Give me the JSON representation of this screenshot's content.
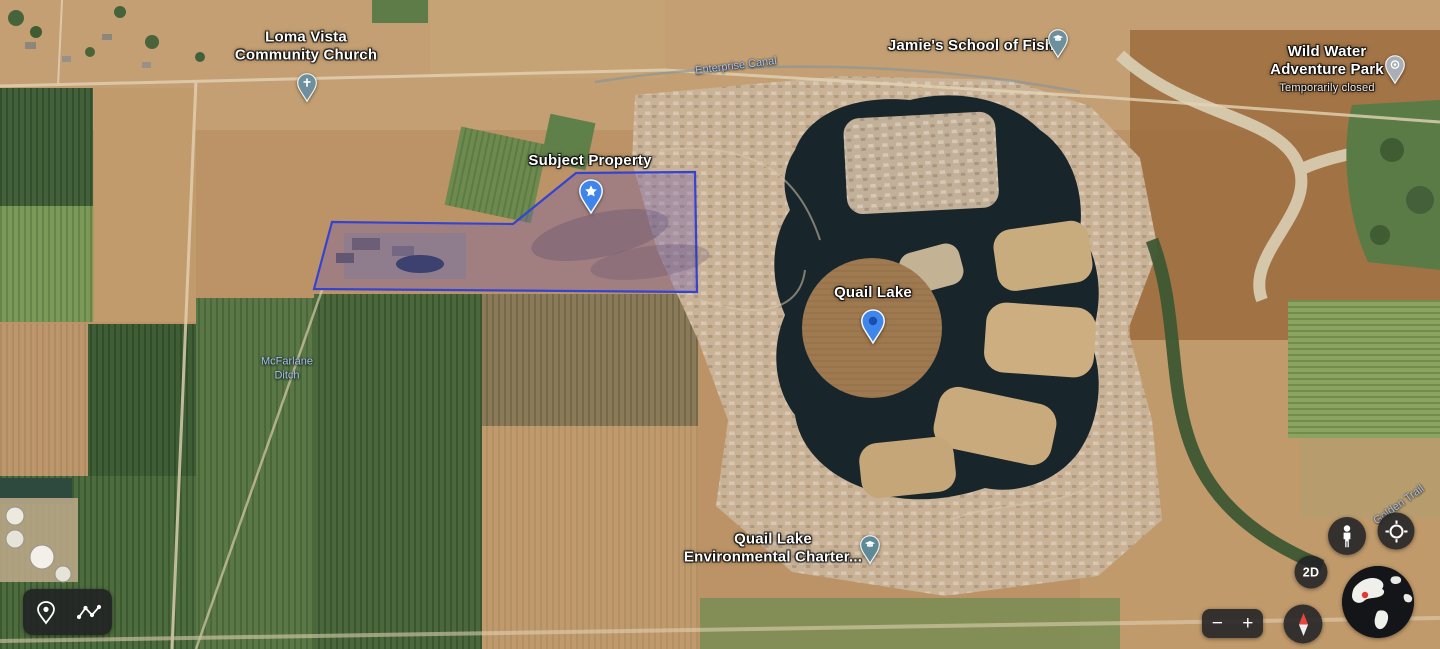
{
  "labels": {
    "loma_vista": {
      "line1": "Loma Vista",
      "line2": "Community Church"
    },
    "enterprise_canal": {
      "text": "Enterprise Canal"
    },
    "jamies_school": {
      "text": "Jamie's School of Fish"
    },
    "wild_water": {
      "line1": "Wild Water",
      "line2": "Adventure Park",
      "status": "Temporarily closed"
    },
    "subject_property": {
      "text": "Subject Property"
    },
    "quail_lake": {
      "text": "Quail Lake"
    },
    "mcfarlane_ditch": {
      "line1": "McFarlane",
      "line2": "Ditch"
    },
    "environmental_charter": {
      "line1": "Quail Lake",
      "line2": "Environmental Charter..."
    },
    "road": {
      "text": "Golden Trail"
    }
  },
  "controls": {
    "zoom_out_label": "−",
    "zoom_in_label": "+",
    "mode_2d_label": "2D"
  },
  "colors": {
    "subject_polygon_stroke": "#3543d2",
    "subject_polygon_fill": "rgba(112,88,182,0.34)",
    "primary_pin_blue": "#3e86ec",
    "pin_inner_dark_blue": "#1b4fae",
    "poi_pin_slate": "#6e8f9c",
    "poi_pin_gray": "#a9afb5",
    "water_label_blue": "#a6c3e8",
    "control_background": "rgba(32,33,36,0.88)",
    "compass_north_red": "#e8453c",
    "water_dark": "#18262c"
  }
}
